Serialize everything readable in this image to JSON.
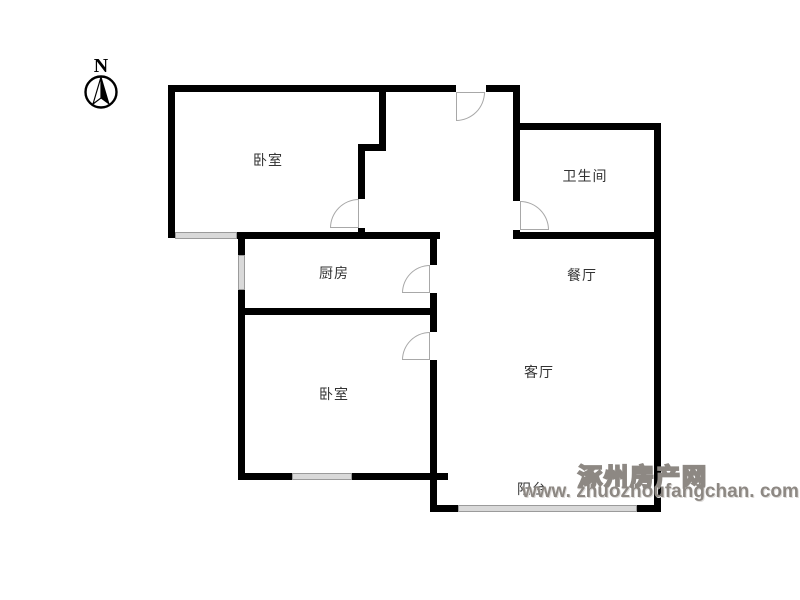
{
  "compass": {
    "north_label": "N"
  },
  "rooms": [
    {
      "name": "bedroom-top",
      "label": "卧室"
    },
    {
      "name": "bathroom",
      "label": "卫生间"
    },
    {
      "name": "kitchen",
      "label": "厨房"
    },
    {
      "name": "dining-room",
      "label": "餐厅"
    },
    {
      "name": "living-room",
      "label": "客厅"
    },
    {
      "name": "bedroom-bottom",
      "label": "卧室"
    },
    {
      "name": "balcony",
      "label": "阳台"
    }
  ],
  "watermark": {
    "site_name": "涿州房产网",
    "site_url": "www. zhuozhoufangchan. com"
  },
  "floorplan": {
    "wall_color": "#000000",
    "window_color": "#d9d9d9",
    "door_arc_color": "#a8a8a8",
    "walls": [
      {
        "x": 168,
        "y": 85,
        "w": 288,
        "h": 7
      },
      {
        "x": 486,
        "y": 85,
        "w": 34,
        "h": 7
      },
      {
        "x": 168,
        "y": 85,
        "w": 7,
        "h": 153
      },
      {
        "x": 237,
        "y": 232,
        "w": 203,
        "h": 7
      },
      {
        "x": 238,
        "y": 232,
        "w": 7,
        "h": 23
      },
      {
        "x": 238,
        "y": 290,
        "w": 7,
        "h": 190
      },
      {
        "x": 379,
        "y": 92,
        "w": 7,
        "h": 59
      },
      {
        "x": 358,
        "y": 144,
        "w": 28,
        "h": 7
      },
      {
        "x": 358,
        "y": 151,
        "w": 7,
        "h": 48
      },
      {
        "x": 358,
        "y": 228,
        "w": 7,
        "h": 11
      },
      {
        "x": 430,
        "y": 232,
        "w": 7,
        "h": 33
      },
      {
        "x": 430,
        "y": 293,
        "w": 7,
        "h": 39
      },
      {
        "x": 430,
        "y": 360,
        "w": 7,
        "h": 152
      },
      {
        "x": 245,
        "y": 308,
        "w": 185,
        "h": 7
      },
      {
        "x": 245,
        "y": 473,
        "w": 47,
        "h": 7
      },
      {
        "x": 352,
        "y": 473,
        "w": 96,
        "h": 7
      },
      {
        "x": 437,
        "y": 505,
        "w": 21,
        "h": 7
      },
      {
        "x": 637,
        "y": 505,
        "w": 24,
        "h": 7
      },
      {
        "x": 654,
        "y": 123,
        "w": 7,
        "h": 389
      },
      {
        "x": 513,
        "y": 123,
        "w": 148,
        "h": 7
      },
      {
        "x": 513,
        "y": 85,
        "w": 7,
        "h": 116
      },
      {
        "x": 513,
        "y": 230,
        "w": 7,
        "h": 9
      },
      {
        "x": 513,
        "y": 232,
        "w": 148,
        "h": 7
      }
    ],
    "windows": [
      {
        "x": 175,
        "y": 232,
        "w": 62,
        "h": 7
      },
      {
        "x": 238,
        "y": 255,
        "w": 7,
        "h": 35
      },
      {
        "x": 292,
        "y": 473,
        "w": 60,
        "h": 7
      },
      {
        "x": 458,
        "y": 505,
        "w": 179,
        "h": 7
      }
    ],
    "doors": [
      {
        "room": "bedroom-top",
        "x": 330,
        "y": 199,
        "size": 29,
        "corner": "tl"
      },
      {
        "room": "entry",
        "x": 456,
        "y": 92,
        "size": 29,
        "corner": "br"
      },
      {
        "room": "bathroom",
        "x": 520,
        "y": 201,
        "size": 29,
        "corner": "tr"
      },
      {
        "room": "kitchen",
        "x": 402,
        "y": 265,
        "size": 28,
        "corner": "tl"
      },
      {
        "room": "bedroom-bottom",
        "x": 402,
        "y": 332,
        "size": 28,
        "corner": "tl"
      }
    ]
  }
}
